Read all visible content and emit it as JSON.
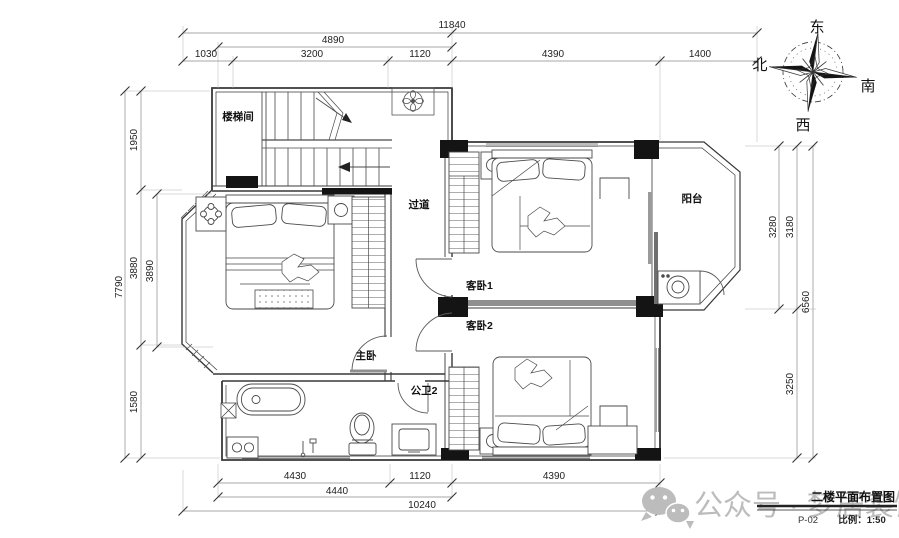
{
  "floor_plan": {
    "rooms": {
      "stairwell": "楼梯间",
      "corridor": "过道",
      "balcony": "阳台",
      "guest_bedroom_1": "客卧1",
      "guest_bedroom_2": "客卧2",
      "master_bedroom": "主卧",
      "bathroom_2": "公卫2"
    },
    "dimensions": {
      "top": {
        "total": "11840",
        "subtotal": "4890",
        "seg1": "1030",
        "seg2": "3200",
        "seg3": "1120",
        "seg4": "4390",
        "seg5": "1400"
      },
      "left": {
        "total": "7790",
        "seg1": "1950",
        "seg2": "3880",
        "seg3": "1580",
        "inner": "3890"
      },
      "right": {
        "total": "6560",
        "outer": "3280",
        "seg1": "3180",
        "seg2": "3250"
      },
      "bottom": {
        "seg1": "4430",
        "seg2": "1120",
        "seg3": "4390",
        "subtotal": "4440",
        "total": "10240"
      }
    },
    "compass": {
      "east": "东",
      "north": "北",
      "south": "南",
      "west": "西"
    }
  },
  "title_block": {
    "drawing_title": "二楼平面布置图",
    "sheet_number": "P-02",
    "scale": "比例：1:50"
  },
  "watermark": {
    "text": "公众号 · 梦居装饰"
  }
}
